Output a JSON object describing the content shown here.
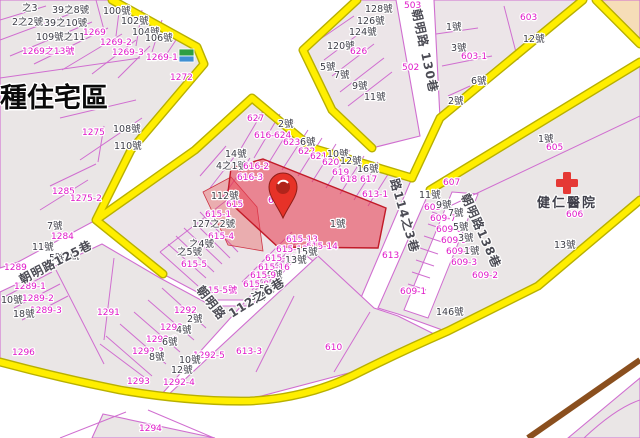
{
  "app": {
    "type": "cadastral-map-viewer"
  },
  "zone": {
    "label": "種住宅區"
  },
  "hospital": {
    "name": "健仁醫院",
    "parcel": "606"
  },
  "selected": {
    "parcel": "616",
    "house": "1號"
  },
  "roads": [
    "朝明路125巷",
    "朝明路 130巷",
    "朝明路138巷",
    "朝明路112之6巷",
    "路114之3巷"
  ],
  "colors": {
    "road_border": "#ffee00",
    "parcel_line": "#d06ed0",
    "parcel_label": "#e019c9",
    "house_label": "#3d3d47",
    "block_fill": "#eae6e6",
    "highlight": "#e8374a",
    "railway": "#8a4f1e",
    "commercial_zone": "#f6ddb8"
  },
  "labels": [
    {
      "t": "之3",
      "x": 22,
      "y": 11
    },
    {
      "t": "39之8號",
      "x": 52,
      "y": 13
    },
    {
      "t": "100號",
      "x": 103,
      "y": 14
    },
    {
      "t": "2之2號",
      "x": 12,
      "y": 25
    },
    {
      "t": "39之10號",
      "x": 44,
      "y": 26
    },
    {
      "t": "102號",
      "x": 121,
      "y": 24
    },
    {
      "t": "104號",
      "x": 132,
      "y": 35
    },
    {
      "t": "109號之11",
      "x": 36,
      "y": 40,
      "s": 8
    },
    {
      "t": "1269",
      "c": "p",
      "x": 83,
      "y": 35
    },
    {
      "t": "1269-2",
      "c": "p",
      "x": 100,
      "y": 45
    },
    {
      "t": "1269-3",
      "c": "p",
      "x": 112,
      "y": 55
    },
    {
      "t": "106號",
      "x": 145,
      "y": 41
    },
    {
      "t": "1269之13號",
      "c": "p",
      "x": 22,
      "y": 54,
      "s": 8
    },
    {
      "t": "1269-1",
      "c": "p",
      "x": 146,
      "y": 60
    },
    {
      "t": "1272",
      "c": "p",
      "x": 170,
      "y": 80
    },
    {
      "t": "1275",
      "c": "p",
      "x": 82,
      "y": 135
    },
    {
      "t": "108號",
      "x": 113,
      "y": 132
    },
    {
      "t": "110號",
      "x": 114,
      "y": 149
    },
    {
      "t": "1285",
      "c": "p",
      "x": 52,
      "y": 194
    },
    {
      "t": "1275-2",
      "c": "p",
      "x": 70,
      "y": 201
    },
    {
      "t": "7號",
      "x": 47,
      "y": 229
    },
    {
      "t": "1284",
      "c": "p",
      "x": 51,
      "y": 239
    },
    {
      "t": "11號",
      "x": 32,
      "y": 250
    },
    {
      "t": "5號",
      "x": 49,
      "y": 261
    },
    {
      "t": "1號",
      "x": 64,
      "y": 259
    },
    {
      "t": "1289",
      "c": "p",
      "x": 4,
      "y": 270,
      "s": 8
    },
    {
      "t": "1289-1",
      "c": "p",
      "x": 14,
      "y": 289
    },
    {
      "t": "1289-2",
      "c": "p",
      "x": 22,
      "y": 301
    },
    {
      "t": "1289-3",
      "c": "p",
      "x": 30,
      "y": 313
    },
    {
      "t": "10號",
      "x": 1,
      "y": 303
    },
    {
      "t": "18號",
      "x": 13,
      "y": 317
    },
    {
      "t": "朝明路125巷",
      "c": "road",
      "x": 22,
      "y": 284,
      "r": -27,
      "s": 11
    },
    {
      "t": "128號",
      "x": 365,
      "y": 12
    },
    {
      "t": "126號",
      "x": 357,
      "y": 24
    },
    {
      "t": "124號",
      "x": 349,
      "y": 35
    },
    {
      "t": "120號",
      "x": 327,
      "y": 49
    },
    {
      "t": "626",
      "c": "p",
      "x": 350,
      "y": 54
    },
    {
      "t": "5號",
      "x": 320,
      "y": 70
    },
    {
      "t": "7號",
      "x": 334,
      "y": 78
    },
    {
      "t": "9號",
      "x": 352,
      "y": 89
    },
    {
      "t": "11號",
      "x": 364,
      "y": 100
    },
    {
      "t": "503",
      "c": "p",
      "x": 404,
      "y": 8
    },
    {
      "t": "502",
      "c": "p",
      "x": 402,
      "y": 70
    },
    {
      "t": "朝明路 130巷",
      "c": "road",
      "x": 412,
      "y": 10,
      "r": 78,
      "s": 13
    },
    {
      "t": "1號",
      "x": 446,
      "y": 30
    },
    {
      "t": "3號",
      "x": 451,
      "y": 51
    },
    {
      "t": "603-1",
      "c": "p",
      "x": 461,
      "y": 59
    },
    {
      "t": "6號",
      "x": 471,
      "y": 84
    },
    {
      "t": "2號",
      "x": 448,
      "y": 104
    },
    {
      "t": "603",
      "c": "p",
      "x": 520,
      "y": 20
    },
    {
      "t": "12號",
      "x": 523,
      "y": 42
    },
    {
      "t": "1號",
      "x": 538,
      "y": 142
    },
    {
      "t": "605",
      "c": "p",
      "x": 546,
      "y": 150
    },
    {
      "t": "606",
      "c": "p",
      "x": 566,
      "y": 217
    },
    {
      "t": "13號",
      "x": 554,
      "y": 248
    },
    {
      "t": "607",
      "c": "p",
      "x": 443,
      "y": 185
    },
    {
      "t": "11號",
      "x": 419,
      "y": 198
    },
    {
      "t": "609-8",
      "c": "p",
      "x": 424,
      "y": 210,
      "s": 8
    },
    {
      "t": "9號",
      "x": 436,
      "y": 208
    },
    {
      "t": "609-7",
      "c": "p",
      "x": 430,
      "y": 221,
      "s": 8
    },
    {
      "t": "7號",
      "x": 448,
      "y": 216
    },
    {
      "t": "609-6",
      "c": "p",
      "x": 436,
      "y": 232,
      "s": 8
    },
    {
      "t": "5號",
      "x": 453,
      "y": 230
    },
    {
      "t": "609-5",
      "c": "p",
      "x": 441,
      "y": 243,
      "s": 8
    },
    {
      "t": "3號",
      "x": 458,
      "y": 241
    },
    {
      "t": "609-4",
      "c": "p",
      "x": 446,
      "y": 254,
      "s": 8
    },
    {
      "t": "1號",
      "x": 464,
      "y": 254
    },
    {
      "t": "609-3",
      "c": "p",
      "x": 451,
      "y": 265,
      "s": 8
    },
    {
      "t": "609-2",
      "c": "p",
      "x": 472,
      "y": 278
    },
    {
      "t": "609-1",
      "c": "p",
      "x": 400,
      "y": 294
    },
    {
      "t": "146號",
      "x": 436,
      "y": 315
    },
    {
      "t": "朝明路138巷",
      "c": "road",
      "x": 461,
      "y": 196,
      "r": 66,
      "s": 12
    },
    {
      "t": "627",
      "c": "p",
      "x": 247,
      "y": 121
    },
    {
      "t": "2號",
      "x": 278,
      "y": 127
    },
    {
      "t": "616-6",
      "c": "p",
      "x": 254,
      "y": 138,
      "s": 8
    },
    {
      "t": "624",
      "c": "p",
      "x": 274,
      "y": 138,
      "s": 8
    },
    {
      "t": "623",
      "c": "p",
      "x": 283,
      "y": 145
    },
    {
      "t": "6號",
      "x": 300,
      "y": 145
    },
    {
      "t": "622",
      "c": "p",
      "x": 298,
      "y": 154
    },
    {
      "t": "10號",
      "x": 327,
      "y": 157
    },
    {
      "t": "621",
      "c": "p",
      "x": 310,
      "y": 159
    },
    {
      "t": "12號",
      "x": 340,
      "y": 164
    },
    {
      "t": "620",
      "c": "p",
      "x": 322,
      "y": 165
    },
    {
      "t": "16號",
      "x": 357,
      "y": 172
    },
    {
      "t": "619",
      "c": "p",
      "x": 332,
      "y": 175
    },
    {
      "t": "618",
      "c": "p",
      "x": 340,
      "y": 182
    },
    {
      "t": "617",
      "c": "p",
      "x": 360,
      "y": 182
    },
    {
      "t": "14號",
      "x": 225,
      "y": 157
    },
    {
      "t": "4之1號",
      "x": 216,
      "y": 169,
      "s": 8
    },
    {
      "t": "616-2",
      "c": "p",
      "x": 243,
      "y": 169,
      "s": 8
    },
    {
      "t": "616-3",
      "c": "p",
      "x": 237,
      "y": 180,
      "s": 8
    },
    {
      "t": "616",
      "c": "p",
      "x": 268,
      "y": 203
    },
    {
      "t": "112號",
      "x": 211,
      "y": 199
    },
    {
      "t": "615",
      "c": "p",
      "x": 226,
      "y": 207
    },
    {
      "t": "615-1",
      "c": "p",
      "x": 205,
      "y": 217,
      "s": 8
    },
    {
      "t": "127之2號",
      "x": 192,
      "y": 227,
      "s": 8
    },
    {
      "t": "615-4",
      "c": "p",
      "x": 208,
      "y": 239,
      "s": 8
    },
    {
      "t": "之4號",
      "x": 189,
      "y": 247,
      "s": 8
    },
    {
      "t": "之5號",
      "x": 177,
      "y": 255,
      "s": 8
    },
    {
      "t": "615-5",
      "c": "p",
      "x": 181,
      "y": 267,
      "s": 8
    },
    {
      "t": "615-5號",
      "c": "p",
      "x": 202,
      "y": 293,
      "s": 8
    },
    {
      "t": "1號",
      "x": 330,
      "y": 227
    },
    {
      "t": "615-13",
      "c": "p",
      "x": 286,
      "y": 242,
      "s": 8
    },
    {
      "t": "615-14",
      "c": "p",
      "x": 306,
      "y": 249,
      "s": 8
    },
    {
      "t": "615-12",
      "c": "p",
      "x": 276,
      "y": 252,
      "s": 8
    },
    {
      "t": "15號",
      "x": 296,
      "y": 255,
      "s": 8
    },
    {
      "t": "615-10",
      "c": "p",
      "x": 265,
      "y": 261,
      "s": 8
    },
    {
      "t": "13號",
      "x": 285,
      "y": 263,
      "s": 8
    },
    {
      "t": "615-16",
      "c": "p",
      "x": 258,
      "y": 270,
      "s": 8
    },
    {
      "t": "9號",
      "x": 267,
      "y": 278,
      "s": 8
    },
    {
      "t": "615-9",
      "c": "p",
      "x": 250,
      "y": 278,
      "s": 8
    },
    {
      "t": "615-8",
      "c": "p",
      "x": 243,
      "y": 287,
      "s": 8
    },
    {
      "t": "5號",
      "x": 259,
      "y": 292,
      "s": 8
    },
    {
      "t": "3號",
      "x": 250,
      "y": 300,
      "s": 8
    },
    {
      "t": "613-1",
      "c": "p",
      "x": 362,
      "y": 197
    },
    {
      "t": "613",
      "c": "p",
      "x": 382,
      "y": 258
    },
    {
      "t": "路114之3巷",
      "c": "road",
      "x": 390,
      "y": 180,
      "r": 74,
      "s": 12
    },
    {
      "t": "1291",
      "c": "p",
      "x": 97,
      "y": 315
    },
    {
      "t": "1292",
      "c": "p",
      "x": 174,
      "y": 313
    },
    {
      "t": "2號",
      "x": 187,
      "y": 322
    },
    {
      "t": "1292-1",
      "c": "p",
      "x": 160,
      "y": 330,
      "s": 8
    },
    {
      "t": "4號",
      "x": 176,
      "y": 333
    },
    {
      "t": "1292-2",
      "c": "p",
      "x": 146,
      "y": 342,
      "s": 8
    },
    {
      "t": "6號",
      "x": 162,
      "y": 345
    },
    {
      "t": "1292-3",
      "c": "p",
      "x": 132,
      "y": 354,
      "s": 8
    },
    {
      "t": "8號",
      "x": 149,
      "y": 360
    },
    {
      "t": "1292-5",
      "c": "p",
      "x": 193,
      "y": 358,
      "s": 8
    },
    {
      "t": "10號",
      "x": 179,
      "y": 363
    },
    {
      "t": "12號",
      "x": 171,
      "y": 373
    },
    {
      "t": "1292-4",
      "c": "p",
      "x": 163,
      "y": 385
    },
    {
      "t": "1293",
      "c": "p",
      "x": 127,
      "y": 384
    },
    {
      "t": "1296",
      "c": "p",
      "x": 12,
      "y": 355
    },
    {
      "t": "朝明路",
      "c": "road",
      "x": 196,
      "y": 290,
      "r": 52,
      "s": 11
    },
    {
      "t": "112之6巷",
      "c": "road",
      "x": 232,
      "y": 318,
      "r": -32,
      "s": 14
    },
    {
      "t": "610",
      "c": "p",
      "x": 325,
      "y": 350
    },
    {
      "t": "613-3",
      "c": "p",
      "x": 236,
      "y": 354
    },
    {
      "t": "1294",
      "c": "p",
      "x": 139,
      "y": 431
    }
  ]
}
